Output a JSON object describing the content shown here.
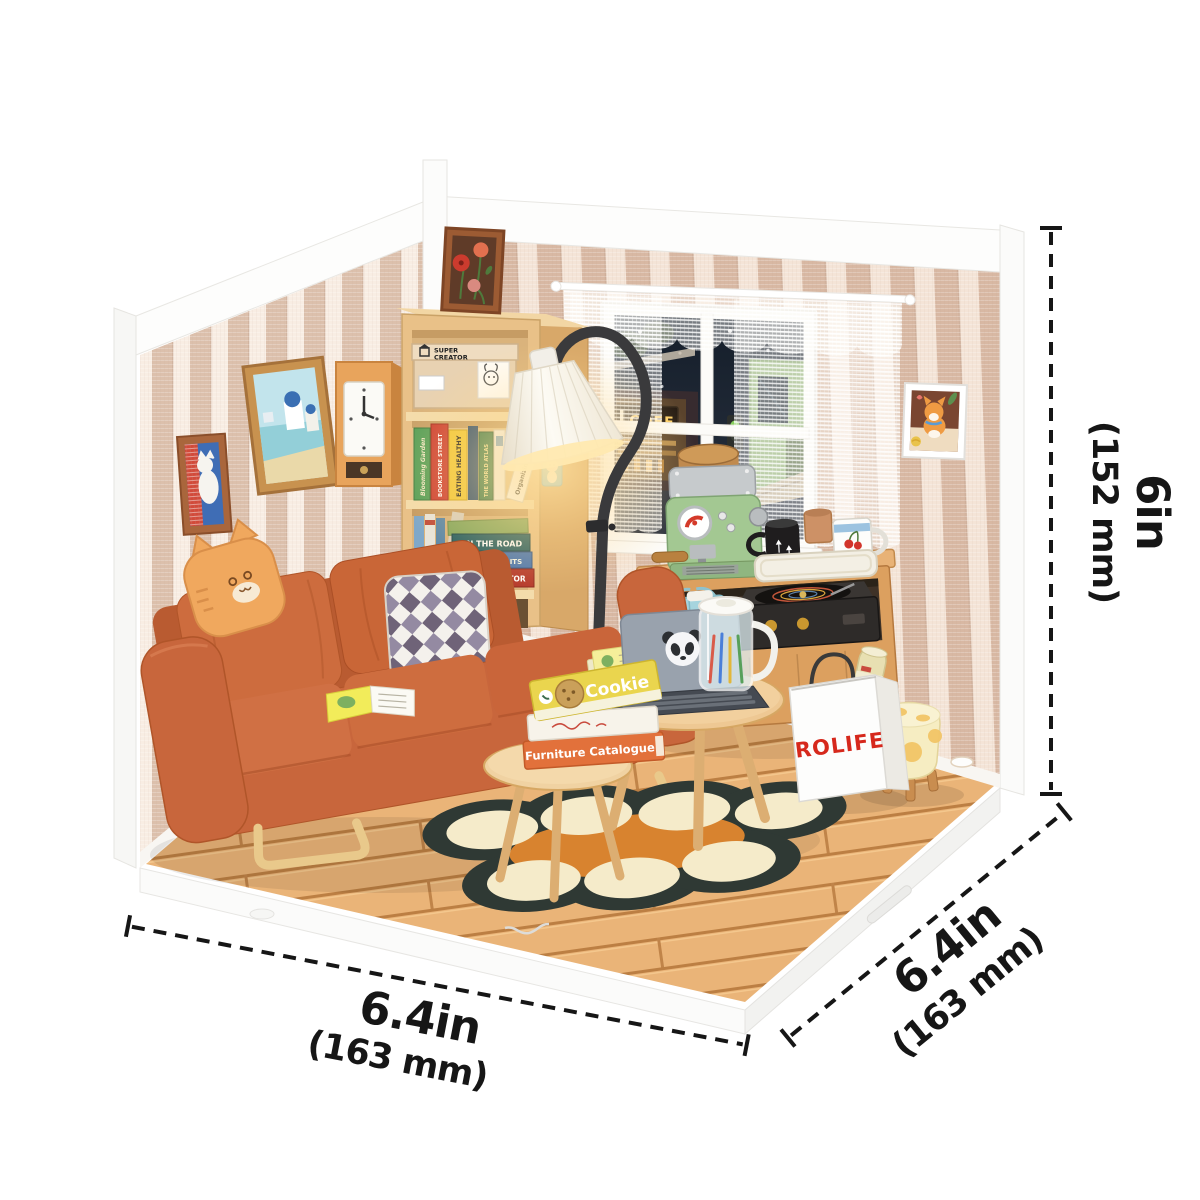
{
  "annotations": {
    "height": {
      "value": "6in",
      "metric": "(152 mm)"
    },
    "width_front": {
      "value": "6.4in",
      "metric": "(163 mm)"
    },
    "depth_side": {
      "value": "6.4in",
      "metric": "(163 mm)"
    }
  },
  "scene": {
    "bag_brand": "ROLIFE",
    "bag_magazine": "AN",
    "window_sign": "COFF",
    "storage_box": [
      "SUPER",
      "CREATOR"
    ],
    "shelf_books": [
      "Blooming Garden",
      "BOOKSTORE STREET",
      "EATING HEALTHY",
      "THE WORLD ATLAS",
      "Organizing"
    ],
    "stacked_books": [
      "ON THE ROAD",
      "7 GOOD HABITS",
      "SUPER CREATOR"
    ],
    "table_books": [
      "Cookie",
      "Furniture Catalogue"
    ]
  },
  "colors": {
    "sofa": "#c8663c",
    "wall_stripe_left": "#dcc0ac",
    "wall_stripe_right": "#d8b8a3",
    "wood_floor": "#eab478",
    "rug_base": "#2f3934",
    "rug_circle": "#f5ebca",
    "bag_text": "#d6281c",
    "machine_green": "#a3c892",
    "dimension_ink": "#161616"
  }
}
